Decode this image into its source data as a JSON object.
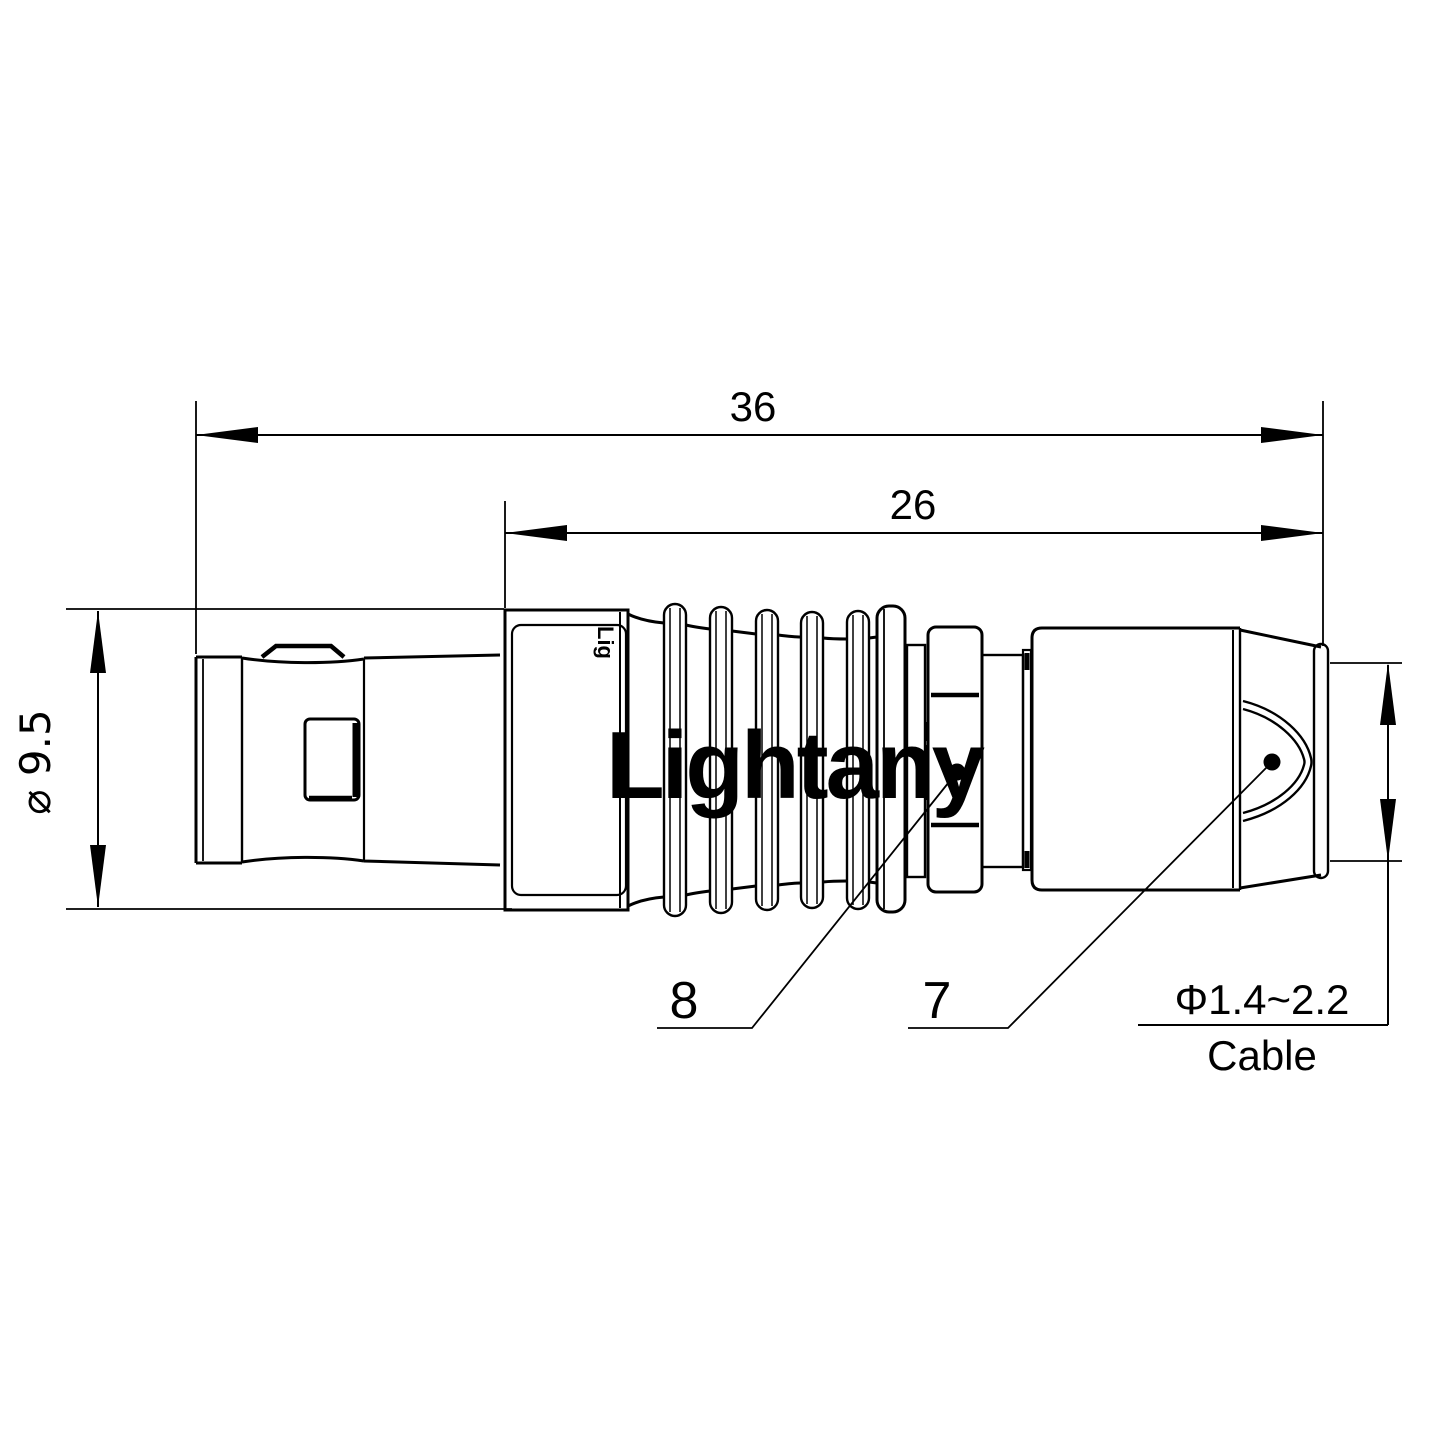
{
  "page": {
    "background": "#ffffff",
    "line_color": "#000000"
  },
  "watermark": {
    "text": "Lightany",
    "color": "#f7d3d6"
  },
  "drawing": {
    "dim_overall_length": "36",
    "dim_body_length": "26",
    "dim_diameter": "⌀ 9.5",
    "dim_cable_diameter": "Φ1.4~2.2",
    "dim_cable_label": "Cable",
    "part_label_8": "8",
    "part_label_7": "7",
    "body_engraving": "Lig"
  }
}
